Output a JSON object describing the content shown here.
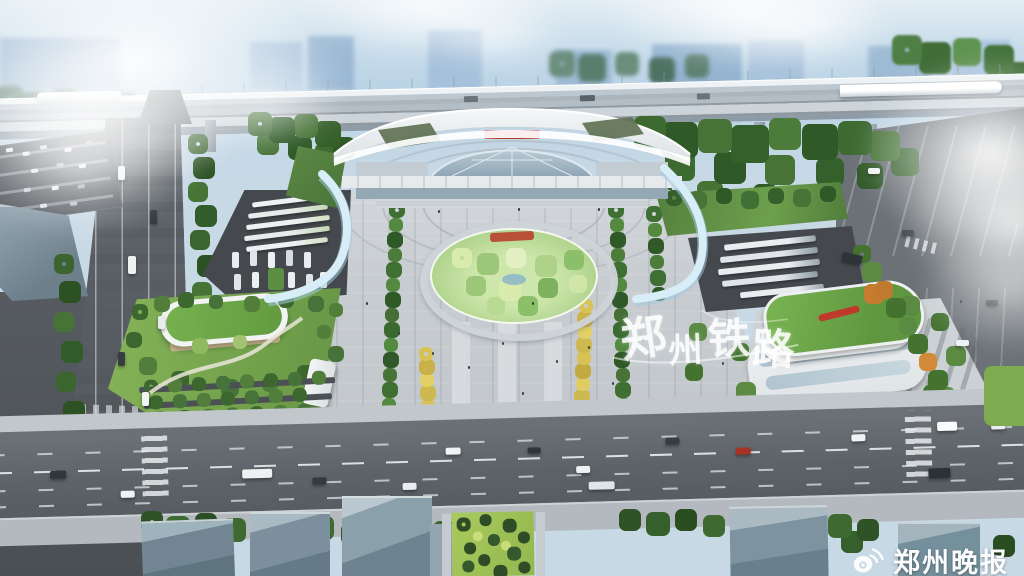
{
  "image": {
    "type": "aerial architectural rendering of a high-speed railway station plaza",
    "watermark": {
      "text": "郑州铁路",
      "chars": [
        "郑",
        "州",
        "铁",
        "路"
      ]
    },
    "press": {
      "icon": "weibo-eye-icon",
      "label": "郑州晚报"
    },
    "station": {
      "sign": "red station-name sign (characters too small to read)",
      "sign_color": "#b13a2c"
    },
    "palette": {
      "sky": "#c6dbea",
      "cloud": "#ffffff",
      "city_haze": "#a9c4dc",
      "viaduct_deck": "#b7c1c9",
      "viaduct_fascia": "#99a4ac",
      "station_roof": "#eef1f2",
      "station_glass": "#a3b6c4",
      "ribbon_blue": "#cfe9f5",
      "plaza": "#c7ccd1",
      "walkway": "#d8dbde",
      "road": "#5d6368",
      "parking_lot": "#45494e",
      "lawn": "#7fae52",
      "garden": "#bcd99b",
      "grass_roof": "#619e41",
      "tree_dark": "#2f5a28",
      "tree_green": "#3f6f33",
      "tree_light": "#548a40",
      "tree_yellow": "#d8c255",
      "tree_orange": "#c07a2f",
      "building_top": "#b7c2ca",
      "building_side": "#7e93a1",
      "water": "#8fb9c6"
    }
  }
}
